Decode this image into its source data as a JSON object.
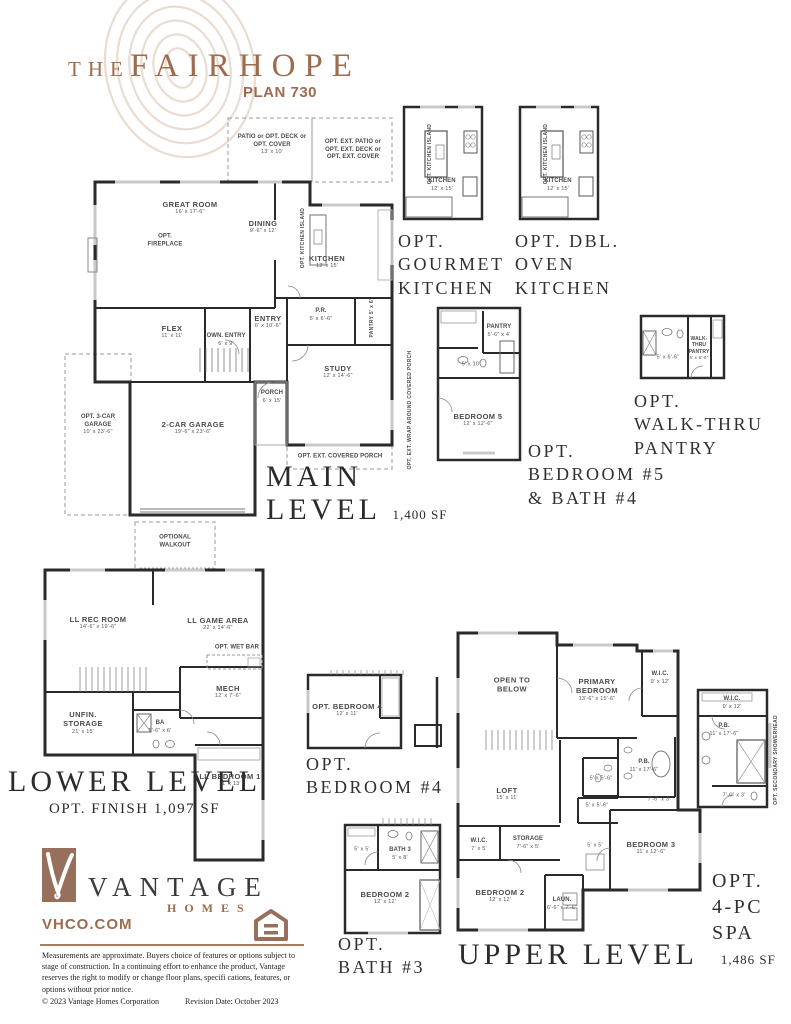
{
  "colors": {
    "accent": "#9e6b4f",
    "logo_brown": "#96705b",
    "wall_ink": "#2a2a2a"
  },
  "header": {
    "the": "THE",
    "name": "FAIRHOPE",
    "plan": "PLAN 730"
  },
  "plans": {
    "main": {
      "patio_n": "PATIO or OPT. DECK or OPT. COVER",
      "patio_d": "13' x 10'",
      "ext_note": "OPT. EXT. PATIO or OPT. EXT. DECK or OPT. EXT. COVER",
      "great_n": "GREAT ROOM",
      "great_d": "16' x 17'-6\"",
      "fireplace": "OPT. FIREPLACE",
      "dining_n": "DINING",
      "dining_d": "9'-6\" x 12'",
      "island": "OPT. KITCHEN ISLAND",
      "kitchen_n": "KITCHEN",
      "kitchen_d": "12' x 15'",
      "flex_n": "FLEX",
      "flex_d": "11' x 11'",
      "own_n": "OWN. ENTRY",
      "own_d": "6' x 9'",
      "entry_n": "ENTRY",
      "entry_d": "6' x 10'-6\"",
      "pr_n": "P.R.",
      "pr_d": "5' x 6'-6\"",
      "pantry_n": "PANTRY",
      "pantry_d": "5' x 6'",
      "study_n": "STUDY",
      "study_d": "12' x 14'-6\"",
      "porch_n": "PORCH",
      "porch_d": "6' x 15'",
      "garage_n": "2-CAR GARAGE",
      "garage_d": "19'-6\" x 23'-6\"",
      "g3_n": "OPT. 3-CAR GARAGE",
      "g3_d": "10' x 23'-6\"",
      "cporch": "OPT. EXT. COVERED PORCH",
      "wrap": "OPT. EXT. WRAP AROUND COVERED PORCH",
      "cap1": "MAIN",
      "cap2": "LEVEL",
      "sqft": "1,400 SF"
    },
    "gourmet": {
      "kitchen_n": "KITCHEN",
      "kitchen_d": "12' x 15'",
      "island": "OPT. KITCHEN ISLAND",
      "cap1": "OPT.",
      "cap2": "GOURMET",
      "cap3": "KITCHEN"
    },
    "dbloven": {
      "kitchen_n": "KITCHEN",
      "kitchen_d": "12' x 15'",
      "island": "OPT. KITCHEN ISLAND",
      "cap1": "OPT. DBL.",
      "cap2": "OVEN",
      "cap3": "KITCHEN"
    },
    "bed5": {
      "pantry_n": "PANTRY",
      "pantry_d": "5'-6\" x 4'",
      "bath_d": "5' x 10'",
      "bed_n": "BEDROOM 5",
      "bed_d": "12' x 12'-6\"",
      "cap1": "OPT.",
      "cap2": "BEDROOM #5",
      "cap3": "& BATH #4"
    },
    "walkthru": {
      "bath_d": "5' x 6'-6\"",
      "pantry_n": "WALK-THRU PANTRY",
      "pantry_d": "5' x 6'-6\"",
      "cap1": "OPT.",
      "cap2": "WALK-THRU",
      "cap3": "PANTRY"
    },
    "lower": {
      "walkout": "OPTIONAL WALKOUT",
      "rec_n": "LL REC ROOM",
      "rec_d": "14'-6\" x 19'-6\"",
      "game_n": "LL GAME AREA",
      "game_d": "22' x 14'-6\"",
      "wetbar": "OPT. WET BAR",
      "mech_n": "MECH",
      "mech_d": "12' x 7'-6\"",
      "unfin_n": "UNFIN. STORAGE",
      "unfin_d": "21' x 15'",
      "ba_n": "BA",
      "ba_d": "5'-6\" x 6'",
      "bed1_n": "LL BEDROOM 1",
      "bed1_d": "11' x 13'",
      "cap1": "LOWER LEVEL",
      "cap2": "OPT. FINISH 1,097 SF"
    },
    "bed4": {
      "bed_n": "OPT. BEDROOM 4",
      "bed_d": "12' x 11'",
      "cap1": "OPT.",
      "cap2": "BEDROOM #4"
    },
    "upper": {
      "open": "OPEN TO BELOW",
      "primary_n": "PRIMARY BEDROOM",
      "primary_d": "13'-6\" x 15'-6\"",
      "wic_n": "W.I.C.",
      "wic_d": "9' x 12'",
      "pb_n": "P.B.",
      "pb_d": "11' x 17'-6\"",
      "loft_n": "LOFT",
      "loft_d": "15' x 11'",
      "bath2_d": "5' x 5'-6\"",
      "bath3_d": "5' x 5'-6\"",
      "hall_d": "7'-6\" x 3'",
      "linen_d": "5' x 5'",
      "wic2_n": "W.I.C.",
      "wic2_d": "7' x 5'",
      "stor_n": "STORAGE",
      "stor_d": "7'-6\" x 5'",
      "bed2_n": "BEDROOM 2",
      "bed2_d": "12' x 12'",
      "laun_n": "LAUN.",
      "laun_d": "6'-6\" x 7'-6\"",
      "bed3_n": "BEDROOM 3",
      "bed3_d": "11' x 12'-6\"",
      "cap1": "UPPER LEVEL",
      "sqft": "1,486 SF"
    },
    "bath3": {
      "wic_d": "5' x 5'",
      "bath_n": "BATH 3",
      "bath_d": "5' x 8'",
      "bed2_n": "BEDROOM 2",
      "bed2_d": "12' x 12'",
      "cap1": "OPT.",
      "cap2": "BATH #3"
    },
    "spa": {
      "wic_n": "W.I.C.",
      "wic_d": "9' x 12'",
      "pb_n": "P.B.",
      "pb_d": "11' x 17'-6\"",
      "shower_note": "OPT. SECONDARY SHOWERHEAD",
      "hall_d": "7'-6\" x 3'",
      "cap1": "OPT.",
      "cap2": "4-PC",
      "cap3": "SPA"
    }
  },
  "footer": {
    "brand": "VANTAGE",
    "brand2": "HOMES",
    "url": "VHCO.COM",
    "disclaimer": "Measurements are approximate. Buyers choice of features or options subject to stage of construction. In a continuing effort to enhance the product, Vantage reserves the right to modify or change floor plans, specifi cations, features, or options without prior notice.",
    "copyright": "© 2023 Vantage Homes Corporation",
    "revision": "Revision Date: October 2023"
  }
}
